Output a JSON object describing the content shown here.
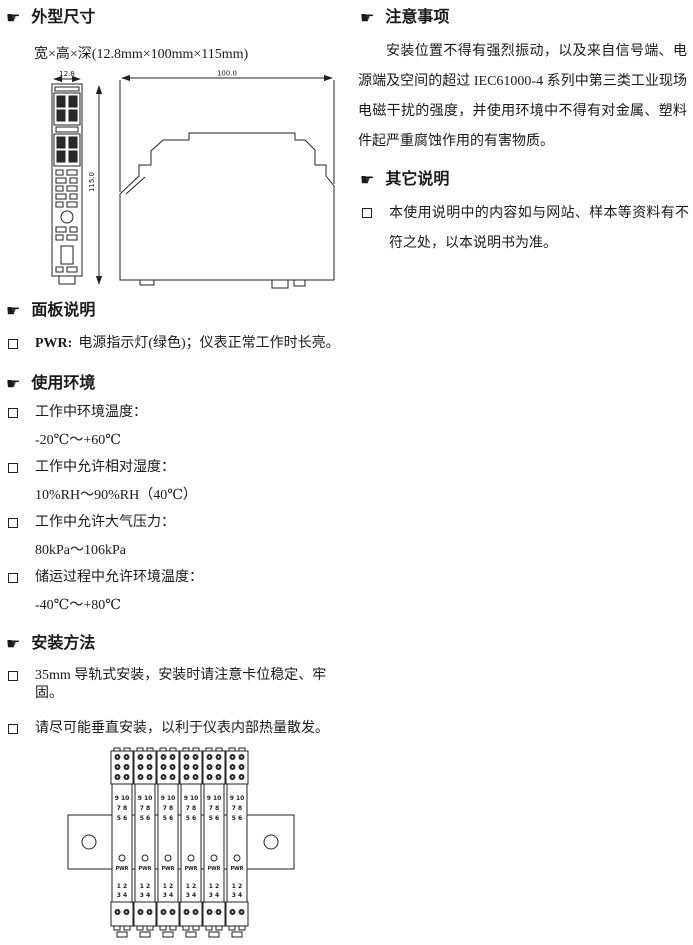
{
  "icons": {
    "section_marker": "☛",
    "checkbox": "□"
  },
  "colors": {
    "text": "#1a1a1a",
    "line": "#222222",
    "background": "#ffffff",
    "screw_fill": "#2a2a2a"
  },
  "left": {
    "dimensions": {
      "title": "外型尺寸",
      "subtitle": "宽×高×深(12.8mm×100mm×115mm)",
      "drawing": {
        "width_label": "12.8",
        "height_label": "100.0",
        "depth_label": "115.0"
      }
    },
    "panel": {
      "title": "面板说明",
      "item_bold": "PWR:",
      "item_text": "电源指示灯(绿色)；仪表正常工作时长亮。"
    },
    "environment": {
      "title": "使用环境",
      "items": [
        {
          "label": "工作中环境温度：",
          "value": "-20℃～+60℃"
        },
        {
          "label": "工作中允许相对湿度：",
          "value": "10%RH～90%RH（40℃）"
        },
        {
          "label": "工作中允许大气压力：",
          "value": "80kPa～106kPa"
        },
        {
          "label": "储运过程中允许环境温度：",
          "value": "-40℃～+80℃"
        }
      ]
    },
    "installation": {
      "title": "安装方法",
      "items": [
        "35mm 导轨式安装，安装时请注意卡位稳定、牢固。",
        "请尽可能垂直安装，以利于仪表内部热量散发。"
      ],
      "figure_caption": "垂直安装示意图",
      "module": {
        "row1": "9 10",
        "row2": "7 8",
        "row3": "5 6",
        "led": "PWR",
        "row4": "1 2",
        "row5": "3 4"
      }
    }
  },
  "right": {
    "notes": {
      "title": "注意事项",
      "paragraph": "安装位置不得有强烈振动，以及来自信号端、电源端及空间的超过 IEC61000-4 系列中第三类工业现场电磁干扰的强度，并使用环境中不得有对金属、塑料件起严重腐蚀作用的有害物质。"
    },
    "other": {
      "title": "其它说明",
      "items": [
        "本使用说明中的内容如与网站、样本等资料有不符之处，以本说明书为准。"
      ]
    }
  }
}
